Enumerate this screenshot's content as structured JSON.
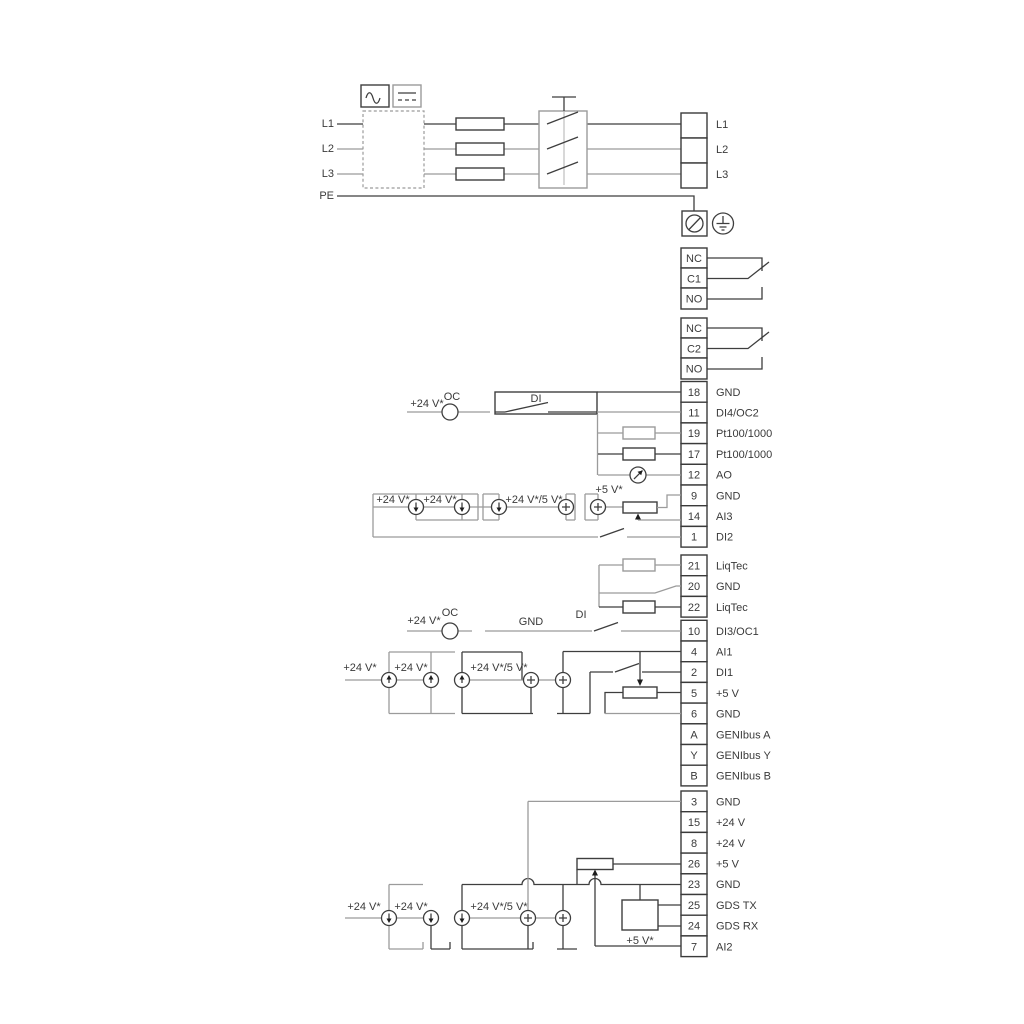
{
  "title": "Pump drive terminal wiring diagram",
  "power": {
    "in": [
      "L1",
      "L2",
      "L3",
      "PE"
    ],
    "out": [
      "L1",
      "L2",
      "L3"
    ]
  },
  "relay1": {
    "rows": [
      "NC",
      "C1",
      "NO"
    ]
  },
  "relay2": {
    "rows": [
      "NC",
      "C2",
      "NO"
    ]
  },
  "io1": {
    "rows": [
      {
        "n": "18",
        "t": "GND"
      },
      {
        "n": "11",
        "t": "DI4/OC2"
      },
      {
        "n": "19",
        "t": "Pt100/1000"
      },
      {
        "n": "17",
        "t": "Pt100/1000"
      },
      {
        "n": "12",
        "t": "AO"
      },
      {
        "n": "9",
        "t": "GND"
      },
      {
        "n": "14",
        "t": "AI3"
      },
      {
        "n": "1",
        "t": "DI2"
      }
    ]
  },
  "liqtec": {
    "rows": [
      {
        "n": "21",
        "t": "LiqTec"
      },
      {
        "n": "20",
        "t": "GND"
      },
      {
        "n": "22",
        "t": "LiqTec"
      }
    ]
  },
  "io2": {
    "rows": [
      {
        "n": "10",
        "t": "DI3/OC1"
      },
      {
        "n": "4",
        "t": "AI1"
      },
      {
        "n": "2",
        "t": "DI1"
      },
      {
        "n": "5",
        "t": "+5 V"
      },
      {
        "n": "6",
        "t": "GND"
      },
      {
        "n": "A",
        "t": "GENIbus A"
      },
      {
        "n": "Y",
        "t": "GENIbus Y"
      },
      {
        "n": "B",
        "t": "GENIbus B"
      }
    ]
  },
  "io3": {
    "rows": [
      {
        "n": "3",
        "t": "GND"
      },
      {
        "n": "15",
        "t": "+24 V"
      },
      {
        "n": "8",
        "t": "+24 V"
      },
      {
        "n": "26",
        "t": "+5 V"
      },
      {
        "n": "23",
        "t": "GND"
      },
      {
        "n": "25",
        "t": "GDS TX"
      },
      {
        "n": "24",
        "t": "GDS RX"
      },
      {
        "n": "7",
        "t": "AI2"
      }
    ]
  },
  "ann": {
    "v24": "+24 V*",
    "v24_5": "+24 V*/5 V*",
    "v5": "+5 V*",
    "oc": "OC",
    "di": "DI",
    "gnd": "GND"
  },
  "colors": {
    "wire_gray": "#9b9b9b",
    "wire_dark": "#3e3e3e",
    "text": "#3a3a3a",
    "background": "#ffffff"
  }
}
